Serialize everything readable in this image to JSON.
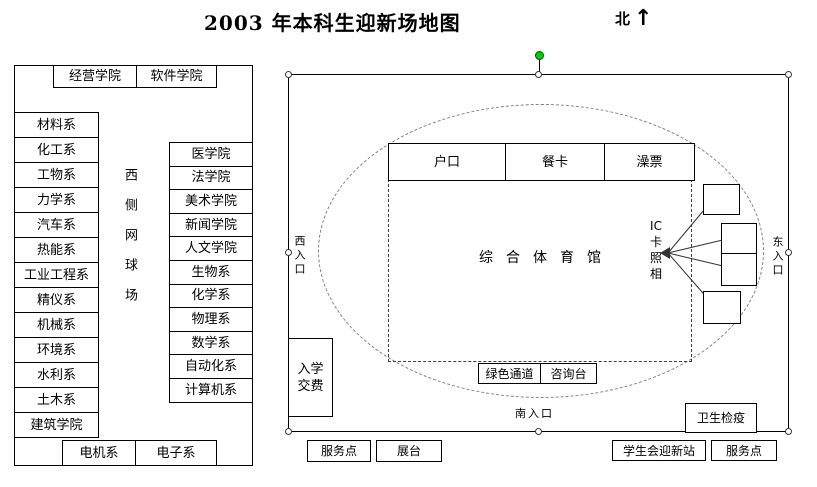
{
  "title": "2003 年本科生迎新场地图",
  "compass": {
    "label": "北",
    "arrow": "↑"
  },
  "left_panel": {
    "top_row": [
      "经营学院",
      "软件学院"
    ],
    "left_column": [
      "材料系",
      "化工系",
      "工物系",
      "力学系",
      "汽车系",
      "热能系",
      "工业工程系",
      "精仪系",
      "机械系",
      "环境系",
      "水利系",
      "土木系",
      "建筑学院"
    ],
    "center_label": "西侧网球场",
    "right_column": [
      "医学院",
      "法学院",
      "美术学院",
      "新闻学院",
      "人文学院",
      "生物系",
      "化学系",
      "物理系",
      "数学系",
      "自动化系",
      "计算机系"
    ],
    "bottom_row": [
      "电机系",
      "电子系"
    ]
  },
  "map": {
    "top_boxes": [
      "户口",
      "餐卡",
      "澡票"
    ],
    "gym_label": "综合体育馆",
    "ic_photo_label": "IC\n卡\n照\n相",
    "west_entrance": "西入口",
    "east_entrance": "东入口",
    "south_entrance": "南入口",
    "fee_box": "入学交费",
    "green_channel": "绿色通道",
    "info_desk": "咨询台",
    "quarantine": "卫生检疫"
  },
  "bottom_row": {
    "service_point_left": "服务点",
    "booth": "展台",
    "student_union_station": "学生会迎新站",
    "service_point_right": "服务点"
  },
  "colors": {
    "rotation_handle": "#00cc00",
    "outline": "#000000",
    "ellipse_dash": "#7f7f7f"
  }
}
